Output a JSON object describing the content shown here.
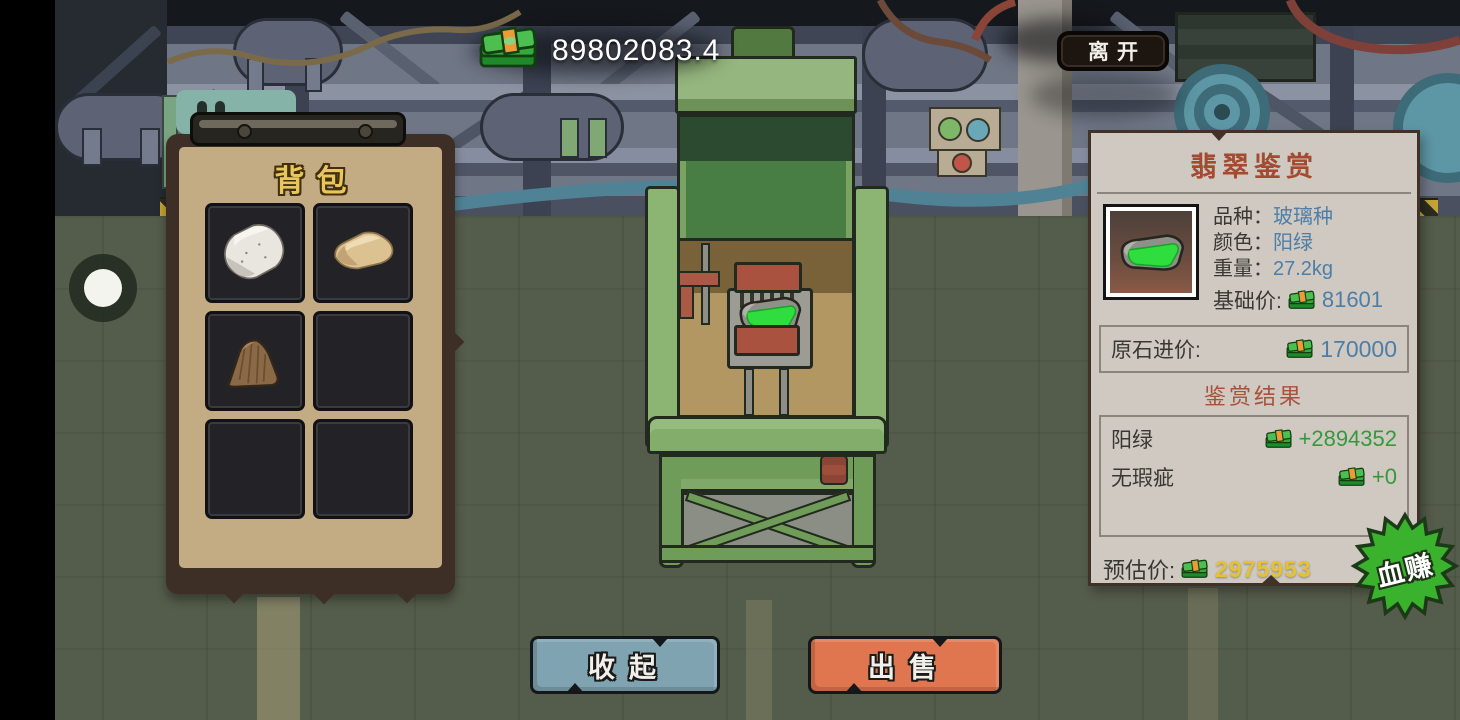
{
  "hud": {
    "money": "89802083.4",
    "leave_label": "离开"
  },
  "backpack": {
    "title": "背包",
    "slots": [
      {
        "item": "white-rough-stone"
      },
      {
        "item": "sand-rough-stone"
      },
      {
        "item": "brown-rough-stone"
      },
      {
        "item": ""
      },
      {
        "item": ""
      },
      {
        "item": ""
      }
    ]
  },
  "appraisal": {
    "title": "翡翠鉴赏",
    "fields": [
      {
        "label": "品种：",
        "value": "玻璃种"
      },
      {
        "label": "颜色：",
        "value": "阳绿"
      },
      {
        "label": "重量：",
        "value": "27.2kg"
      }
    ],
    "base": {
      "label": "基础价:",
      "value": "81601"
    },
    "cost": {
      "label": "原石进价:",
      "value": "170000"
    },
    "result_title": "鉴赏结果",
    "results": [
      {
        "label": "阳绿",
        "value": "+2894352"
      },
      {
        "label": "无瑕疵",
        "value": "+0"
      }
    ],
    "estimate": {
      "label": "预估价:",
      "value": "2975953"
    },
    "badge": "血赚"
  },
  "actions": {
    "collapse": "收起",
    "sell": "出售"
  },
  "colors": {
    "value_blue": "#4c7ea8",
    "gain_green": "#35993c",
    "estimate_yellow": "#e5c233",
    "title_red": "#a34a31",
    "panel_paper": "#cfc9c1",
    "backpack_tan": "#c3ac84",
    "backpack_gold": "#eac65a",
    "collapse_blue": "#7fa3b1",
    "sell_orange": "#df764f",
    "badge_green": "#3bb22d",
    "machine_green": "#8cb573",
    "jade_green": "#2fdd3f"
  }
}
